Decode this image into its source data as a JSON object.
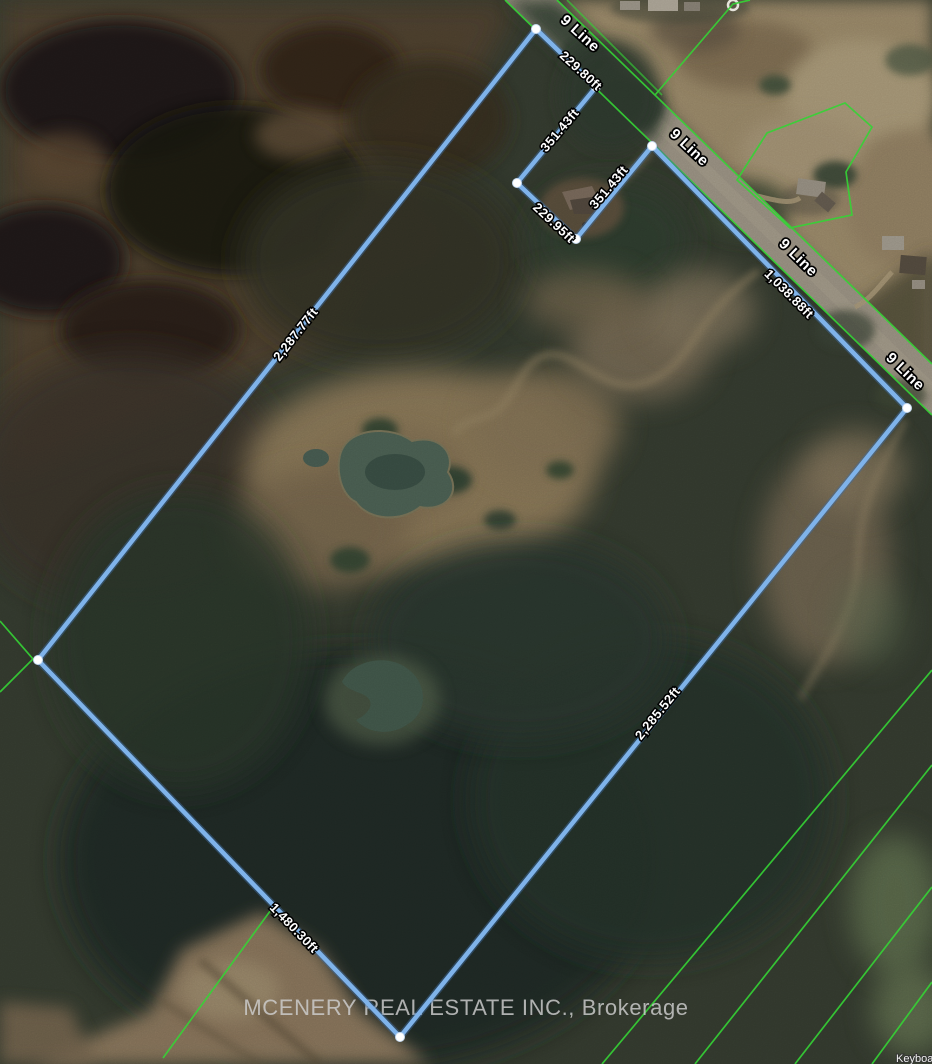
{
  "map": {
    "road": {
      "name": "9 Line"
    },
    "watermark": "MCENERY REAL ESTATE INC., Brokerage",
    "keyboard_shortcuts": "Keyboard shortcuts",
    "colors": {
      "boundary": "#7fb3ea",
      "parcel_lines": "#35d435",
      "vertex_handle": "#ffffff"
    },
    "boundary": {
      "measurements": {
        "front_north": "229.80ft",
        "notch_west": "351.43ft",
        "notch_south": "229.95ft",
        "notch_east": "351.43ft",
        "road_frontage": "1,038.88ft",
        "side_southeast": "2,285.52ft",
        "side_northwest": "2,287.77ft",
        "rear_southwest": "1,480.30ft"
      }
    }
  }
}
